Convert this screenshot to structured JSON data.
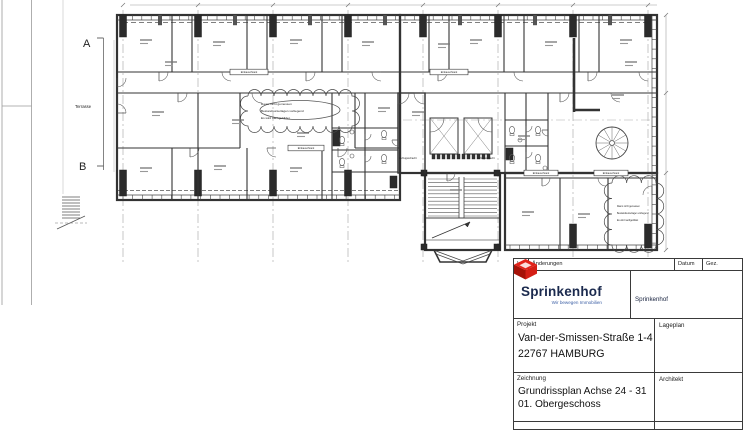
{
  "plan": {
    "marker_a": "A",
    "marker_b": "B",
    "terrasse_label": "Terrasse",
    "cloud_note": [
      "Raum nicht gemessen",
      "Bestandsunterlagen vorliegend",
      "Es wird nachgebildet"
    ],
    "elevator_label": "Aufzugsschacht",
    "closet_label": "Einbauschrank"
  },
  "titleblock": {
    "header": {
      "index": "Index",
      "aenderungen": "Änderungen",
      "datum": "Datum",
      "gez": "Gez."
    },
    "logo": {
      "name": "Sprinkenhof",
      "tagline": "Wir bewegen Immobilien",
      "colors": {
        "red": "#e2231a",
        "dark_red": "#a51208",
        "navy": "#1b2a4e",
        "blue": "#3c5fa5"
      }
    },
    "address": {
      "company": "Sprinkenhof",
      "street": "Burchardstr. 8  20095 HAMBURG",
      "tel_label": "TEL:",
      "tel": "040 / 339 54 - 0",
      "fax_label": "FAX:",
      "fax": "040 / 339 54 285"
    },
    "project": {
      "label": "Projekt",
      "line1": "Van-der-Smissen-Straße 1-4",
      "line2": "22767 HAMBURG"
    },
    "lageplan_label": "Lageplan",
    "drawing": {
      "label": "Zeichnung",
      "line1": "Grundrissplan Achse 24 - 31",
      "line2": "01. Obergeschoss"
    },
    "architekt_label": "Architekt"
  }
}
